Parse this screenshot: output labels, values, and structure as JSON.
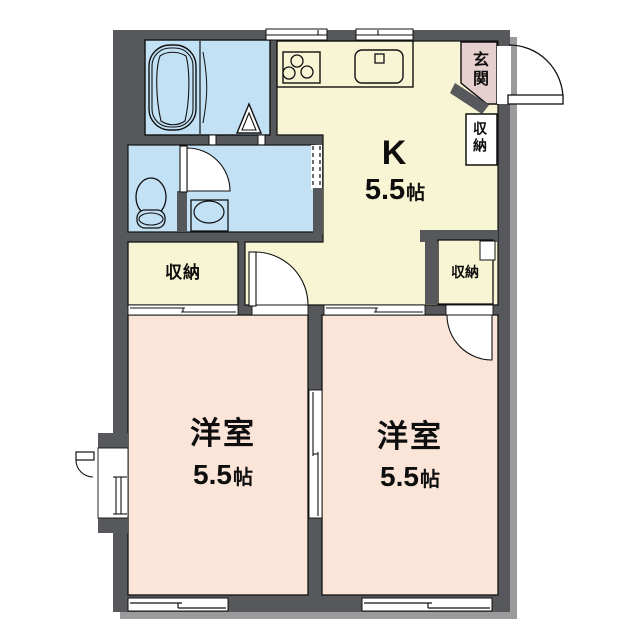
{
  "colors": {
    "wall": "#57585C",
    "wall_shadow": "#9B9B9B",
    "wet_rooms_blue": "#C3E1F5",
    "kitchen_cream": "#F7F5D3",
    "bedroom_pink": "#FAE5D8",
    "entrance_pink": "#E5D0CF",
    "outline": "#111111",
    "door_white": "#FFFFFF"
  },
  "labels": {
    "kitchen": {
      "name": "K",
      "size_value": "5.5",
      "size_unit": "帖"
    },
    "bedroom_left": {
      "name": "洋室",
      "size_value": "5.5",
      "size_unit": "帖"
    },
    "bedroom_right": {
      "name": "洋室",
      "size_value": "5.5",
      "size_unit": "帖"
    },
    "entrance": {
      "name": "玄関"
    },
    "storage_entrance": {
      "name": "収納"
    },
    "storage_left": {
      "name": "収納"
    },
    "storage_right": {
      "name": "収納"
    }
  },
  "fixtures": [
    "bathtub",
    "toilet",
    "washbasin",
    "kitchen-counter",
    "stove-3-burner",
    "kitchen-sink",
    "folding-bath-door",
    "hinged-doors",
    "sliding-doors",
    "sliding-windows",
    "entrance-swing-door",
    "dashed-open-passage"
  ]
}
